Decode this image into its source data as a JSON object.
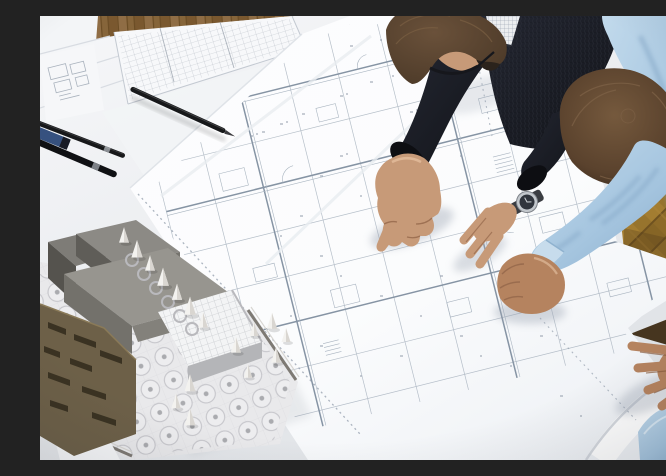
{
  "meta": {
    "title": "Two architects leaning over a drafting table, reviewing large floor-plan drawings beside an architectural scale model",
    "type": "photograph",
    "setting": "architecture studio with golden herringbone parquet floor"
  },
  "scene": {
    "people": [
      {
        "id": "architect-1",
        "description": "man with glasses, beard stubble and dark knit sweater, seen from above, pointing at a detail on the plan with his right index finger",
        "hair": "short brown",
        "accessories": [
          "glasses",
          "steel wristwatch with dark dial"
        ]
      },
      {
        "id": "architect-2",
        "description": "man in a light blue dress shirt, seen from above, leaning on the table with a closed fist and a spread left hand",
        "hair": "short brown"
      }
    ],
    "objects": [
      {
        "id": "floor-plan-sheets",
        "description": "large white architectural floor plan sheets with fine grey linework covering the table, one edge rolling over the table edge at bottom right"
      },
      {
        "id": "schedule-sheet",
        "description": "printed tabular schedule sheet at the top left"
      },
      {
        "id": "sketch-sheets",
        "description": "small sketch sheets with plan doodles in the top-left corner"
      },
      {
        "id": "architectural-model",
        "description": "scale model: grey and olive stacked building volumes, gridded glass hall, white base board with circular landscaping discs and small white conical trees, metal rail edges"
      },
      {
        "id": "pens",
        "description": "black drafting pens and one blue pen at the left edge",
        "count": 4
      },
      {
        "id": "parquet-floor",
        "description": "golden-brown herringbone parquet floor visible at top and right"
      },
      {
        "id": "beige-chair-edge",
        "description": "beige wooden edge visible between the two men"
      }
    ]
  },
  "palette": {
    "table_light": "#f6f7f9",
    "table_mid": "#eaecef",
    "table_dark": "#dee1e5",
    "paper_bright": "#fbfcfd",
    "plan_line": "#a9b4c0",
    "plan_line_bold": "#8694a4",
    "speck": "#929cab",
    "floor_wood": "#8d6a3e",
    "floor_wood_dark": "#6e4f26",
    "floor_gold": "#97732c",
    "floor_shadow": "#46351f",
    "floor_corner": "#2c2215",
    "jacket_dark": "#121419",
    "jacket_light": "#242732",
    "shirt_light": "#c2daec",
    "shirt_mid": "#a5c5df",
    "shirt_deep": "#86a9c8",
    "skin": "#c79a78",
    "skin_deep": "#94664a",
    "skin_dark": "#b5835f",
    "hair_1": "#4a3827",
    "hair_1_light": "#6a513a",
    "hair_2": "#5a422d",
    "hair_2_light": "#75593d",
    "glasses": "#16171c",
    "watch_steel": "#c3c8cd",
    "watch_face": "#30353d",
    "pen_black": "#17181a",
    "pen_blue": "#36517f",
    "model_gray": "#97958f",
    "model_gray_dark": "#5f5d58",
    "model_olive": "#6d6048",
    "model_olive_dark": "#3a3222",
    "model_metal": "#b9b9bd",
    "model_base": "#e9e9eb",
    "folder_beige": "#cfb98d"
  }
}
